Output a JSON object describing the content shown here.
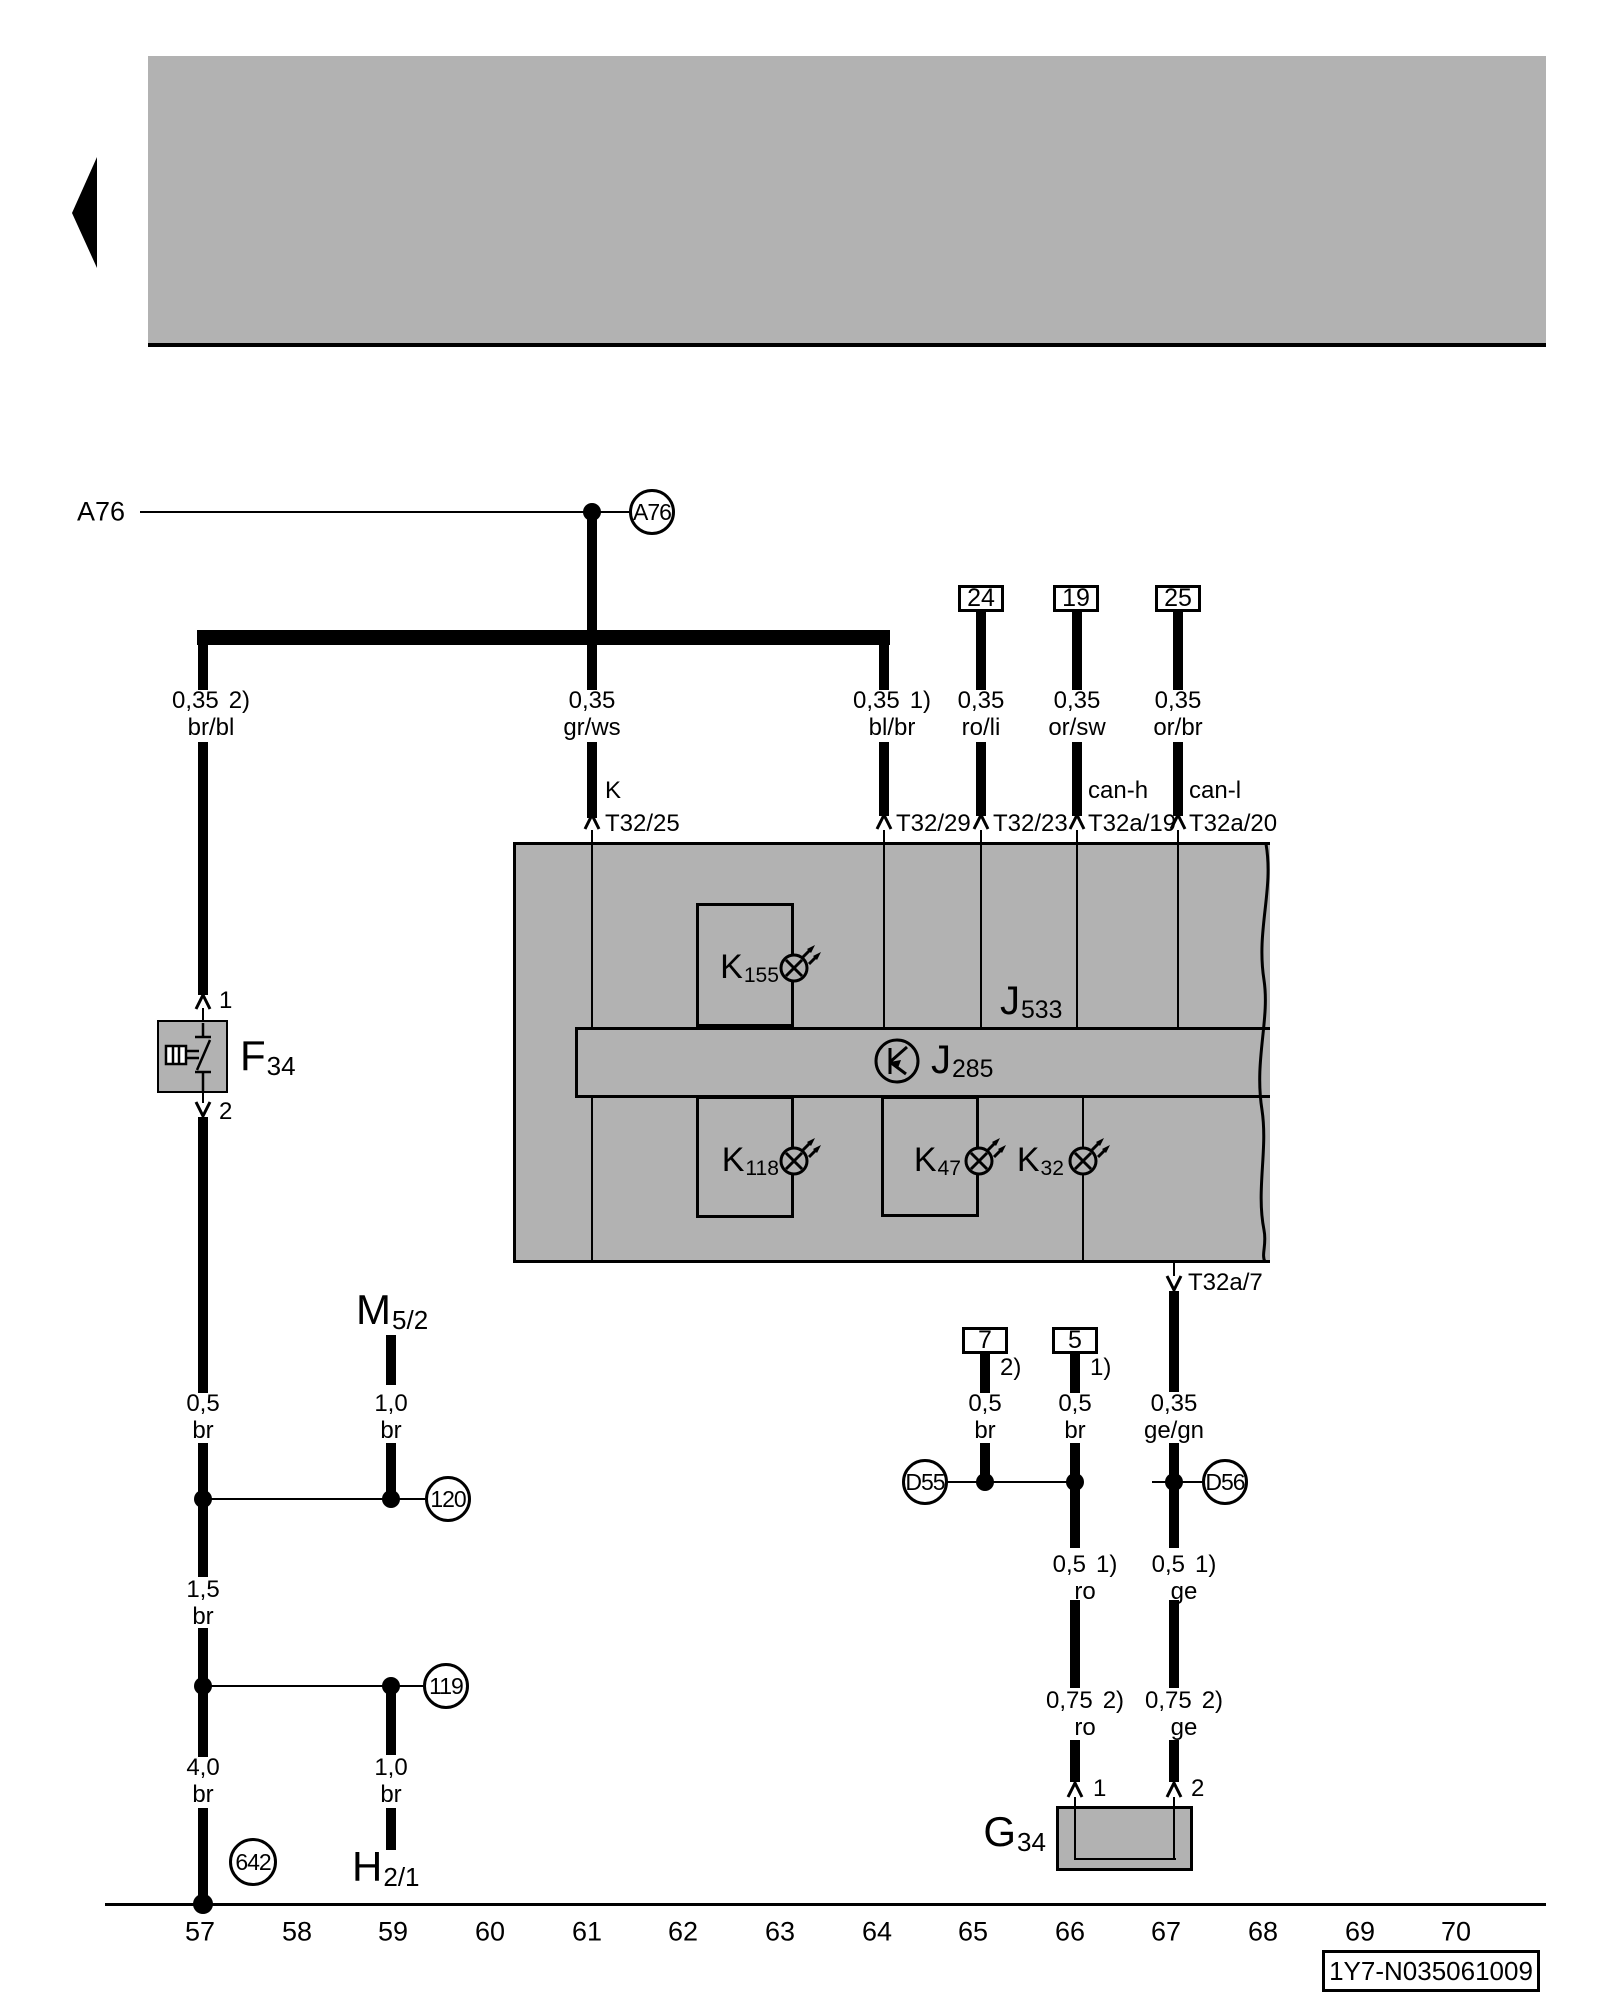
{
  "colors": {
    "panel": "#b2b2b2",
    "ink": "#000000",
    "bg": "#ffffff"
  },
  "banner": {
    "back_icon": "left-arrow"
  },
  "a76": {
    "left_label": "A76",
    "connector": "A76"
  },
  "terminals_top": {
    "t24": "24",
    "t19": "19",
    "t25": "25"
  },
  "wires_top": {
    "brbl": {
      "size": "0,35",
      "note": "2)",
      "color": "br/bl"
    },
    "grws": {
      "size": "0,35",
      "note": "",
      "color": "gr/ws"
    },
    "blbr": {
      "size": "0,35",
      "note": "1)",
      "color": "bl/br"
    },
    "roli": {
      "size": "0,35",
      "note": "",
      "color": "ro/li"
    },
    "orsw": {
      "size": "0,35",
      "note": "",
      "color": "or/sw"
    },
    "orbr": {
      "size": "0,35",
      "note": "",
      "color": "or/br"
    }
  },
  "pins": {
    "k": "K",
    "t32_25": "T32/25",
    "t32_29": "T32/29",
    "t32_23": "T32/23",
    "can_h": "can-h",
    "t32a_19": "T32a/19",
    "can_l": "can-l",
    "t32a_20": "T32a/20",
    "t32a_7": "T32a/7"
  },
  "unit": {
    "j533": {
      "main": "J",
      "sub": "533"
    },
    "j285": {
      "main": "J",
      "sub": "285"
    },
    "k155": {
      "main": "K",
      "sub": "155"
    },
    "k118": {
      "main": "K",
      "sub": "118"
    },
    "k47": {
      "main": "K",
      "sub": "47"
    },
    "k32": {
      "main": "K",
      "sub": "32"
    }
  },
  "f34": {
    "label": {
      "main": "F",
      "sub": "34"
    },
    "pin_top": "1",
    "pin_bottom": "2"
  },
  "m": {
    "main": "M",
    "sub": "5/2"
  },
  "h": {
    "main": "H",
    "sub": "2/1"
  },
  "g34": {
    "label": {
      "main": "G",
      "sub": "34"
    },
    "pin_left": "1",
    "pin_right": "2"
  },
  "wires_left": {
    "w05": {
      "size": "0,5",
      "color": "br"
    },
    "w10_top": {
      "size": "1,0",
      "color": "br"
    },
    "w15": {
      "size": "1,5",
      "color": "br"
    },
    "w40": {
      "size": "4,0",
      "color": "br"
    },
    "w10_bottom": {
      "size": "1,0",
      "color": "br"
    }
  },
  "ground_points": {
    "c120": "120",
    "c119": "119",
    "c642": "642"
  },
  "terminals_bottom": {
    "t7": "7",
    "t7_note": "2)",
    "t5": "5",
    "t5_note": "1)"
  },
  "wires_bottom": {
    "b_br_left": {
      "size": "0,5",
      "note": "",
      "color": "br"
    },
    "b_br_mid": {
      "size": "0,5",
      "note": "",
      "color": "br"
    },
    "b_gegn": {
      "size": "0,35",
      "note": "",
      "color": "ge/gn"
    },
    "b_ro_05": {
      "size": "0,5",
      "note": "1)",
      "color": "ro"
    },
    "b_ge_05": {
      "size": "0,5",
      "note": "1)",
      "color": "ge"
    },
    "b_ro_075": {
      "size": "0,75",
      "note": "2)",
      "color": "ro"
    },
    "b_ge_075": {
      "size": "0,75",
      "note": "2)",
      "color": "ge"
    }
  },
  "splices": {
    "d55": "D55",
    "d56": "D56"
  },
  "scale": {
    "numbers": [
      "57",
      "58",
      "59",
      "60",
      "61",
      "62",
      "63",
      "64",
      "65",
      "66",
      "67",
      "68",
      "69",
      "70"
    ]
  },
  "footer": {
    "part_number": "1Y7-N035061009"
  }
}
